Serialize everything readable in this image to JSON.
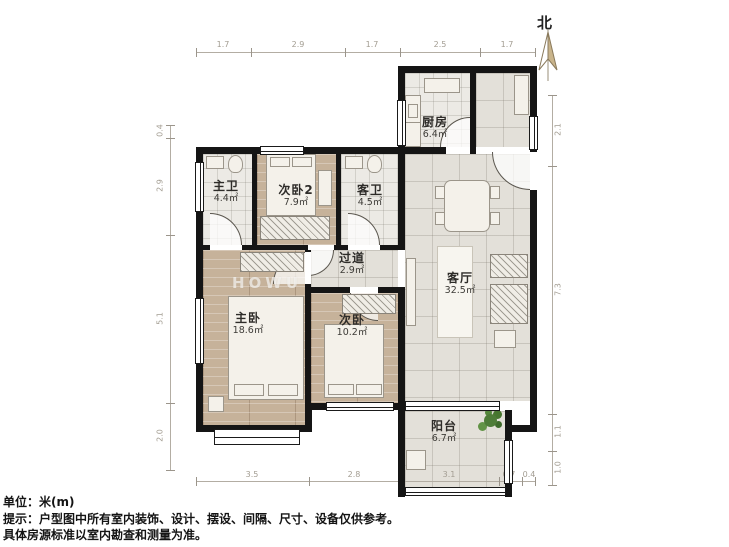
{
  "compass": {
    "label": "北"
  },
  "watermark": {
    "text": "HOWU"
  },
  "rooms": [
    {
      "id": "kitchen",
      "name": "厨房",
      "area": "6.4㎡"
    },
    {
      "id": "master-bath",
      "name": "主卫",
      "area": "4.4㎡"
    },
    {
      "id": "bedroom2",
      "name": "次卧2",
      "area": "7.9㎡"
    },
    {
      "id": "guest-bath",
      "name": "客卫",
      "area": "4.5㎡"
    },
    {
      "id": "corridor",
      "name": "过道",
      "area": "2.9㎡"
    },
    {
      "id": "living-room",
      "name": "客厅",
      "area": "32.5㎡"
    },
    {
      "id": "master-bed",
      "name": "主卧",
      "area": "18.6㎡"
    },
    {
      "id": "bedroom",
      "name": "次卧",
      "area": "10.2㎡"
    },
    {
      "id": "balcony",
      "name": "阳台",
      "area": "6.7㎡"
    }
  ],
  "dimensions": {
    "top": [
      "1.7",
      "2.9",
      "1.7",
      "2.5",
      "1.7"
    ],
    "bottom": [
      "3.5",
      "2.8",
      "3.1",
      "0.7",
      "0.4"
    ],
    "left": [
      "0.4",
      "2.9",
      "5.1",
      "2.0"
    ],
    "right": [
      "2.1",
      "7.3",
      "1.1",
      "1.0"
    ]
  },
  "footer": {
    "unit": "单位：米(m)",
    "tip1": "提示：户型图中所有室内装饰、设计、摆设、间隔、尺寸、设备仅供参考。",
    "tip2": "具体房源标准以室内勘查和测量为准。"
  },
  "palette": {
    "wall": "#151515",
    "tile_floor": "#e3e0d9",
    "wood_floor": "#c6b29a",
    "bath_floor": "#eceae5",
    "plant_green": "#4e7c38",
    "dimension_gray": "#a39d92"
  }
}
